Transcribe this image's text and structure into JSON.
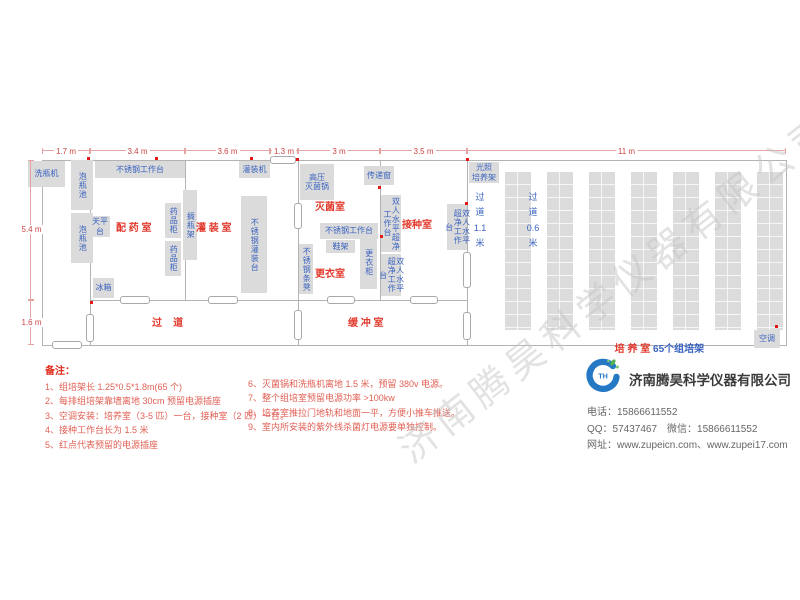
{
  "watermark": "济南腾昊科学仪器有限公司",
  "plan": {
    "dims_top": [
      {
        "label": "1.7 m",
        "x1": 42,
        "x2": 90
      },
      {
        "label": "3.4 m",
        "x1": 90,
        "x2": 185
      },
      {
        "label": "3.6 m",
        "x1": 185,
        "x2": 270
      },
      {
        "label": "1.3 m",
        "x1": 270,
        "x2": 298
      },
      {
        "label": "3 m",
        "x1": 298,
        "x2": 380
      },
      {
        "label": "3.5 m",
        "x1": 380,
        "x2": 467
      },
      {
        "label": "11 m",
        "x1": 467,
        "x2": 786
      }
    ],
    "dims_left": [
      {
        "label": "5.4 m",
        "y1": 160,
        "y2": 300
      },
      {
        "label": "1.6 m",
        "y1": 300,
        "y2": 345
      }
    ],
    "rooms": [
      {
        "name": "room-dispensing",
        "label": "配 药 室",
        "x": 116,
        "y": 219
      },
      {
        "name": "room-filling",
        "label": "灌 装 室",
        "x": 196,
        "y": 219
      },
      {
        "name": "room-sterilizing",
        "label": "灭菌室",
        "x": 315,
        "y": 198
      },
      {
        "name": "room-inoculation",
        "label": "接种室",
        "x": 402,
        "y": 216
      },
      {
        "name": "room-changing",
        "label": "更衣室",
        "x": 315,
        "y": 265
      },
      {
        "name": "corridor",
        "label": "过    道",
        "x": 152,
        "y": 314
      },
      {
        "name": "room-buffer",
        "label": "缓 冲 室",
        "x": 348,
        "y": 314
      }
    ],
    "culture_room_red": "培 养 室 ",
    "culture_room_blue": "65个组培架",
    "corridors": [
      {
        "name": "aisle-1-1m",
        "label": "过\n道\n1.1\n米",
        "x": 472,
        "y": 190
      },
      {
        "name": "aisle-0-6m",
        "label": "过\n道\n0.6\n米",
        "x": 525,
        "y": 190
      }
    ],
    "racks": {
      "count": 7,
      "x": 505,
      "y": 172,
      "w": 26,
      "stride": 42,
      "h": 158
    },
    "equipment": [
      {
        "name": "bottle-washer",
        "label": "洗瓶机",
        "x": 28,
        "y": 161,
        "w": 37,
        "h": 26,
        "v": false
      },
      {
        "name": "soak-pool-1",
        "label": "泡瓶池",
        "x": 71,
        "y": 160,
        "w": 22,
        "h": 50,
        "v": true
      },
      {
        "name": "soak-pool-2",
        "label": "泡瓶池",
        "x": 71,
        "y": 213,
        "w": 22,
        "h": 50,
        "v": true
      },
      {
        "name": "steel-workbench-1",
        "label": "不锈钢工作台",
        "x": 95,
        "y": 161,
        "w": 90,
        "h": 17,
        "v": false
      },
      {
        "name": "filling-machine",
        "label": "灌装机",
        "x": 239,
        "y": 161,
        "w": 31,
        "h": 17,
        "v": false
      },
      {
        "name": "balance-table",
        "label": "天平台",
        "x": 90,
        "y": 216,
        "w": 20,
        "h": 21,
        "v": false
      },
      {
        "name": "medicine-cabinet-1",
        "label": "药品柜",
        "x": 165,
        "y": 203,
        "w": 16,
        "h": 35,
        "v": true
      },
      {
        "name": "medicine-cabinet-2",
        "label": "药品柜",
        "x": 165,
        "y": 241,
        "w": 16,
        "h": 35,
        "v": true
      },
      {
        "name": "bottle-rack",
        "label": "搁瓶架",
        "x": 183,
        "y": 190,
        "w": 14,
        "h": 70,
        "v": true
      },
      {
        "name": "steel-filling-table",
        "label": "不锈钢灌装台",
        "x": 241,
        "y": 196,
        "w": 26,
        "h": 97,
        "v": true
      },
      {
        "name": "fridge",
        "label": "冰箱",
        "x": 93,
        "y": 278,
        "w": 21,
        "h": 20,
        "v": false
      },
      {
        "name": "autoclave",
        "label": "高压\n灭菌锅",
        "x": 300,
        "y": 164,
        "w": 34,
        "h": 36,
        "v": false
      },
      {
        "name": "pass-through-window",
        "label": "传递窗",
        "x": 364,
        "y": 166,
        "w": 30,
        "h": 19,
        "v": false
      },
      {
        "name": "clean-bench-1",
        "label": "双人水平超净工作台",
        "x": 381,
        "y": 195,
        "w": 20,
        "h": 57,
        "v": true
      },
      {
        "name": "steel-workbench-2",
        "label": "不锈钢工作台",
        "x": 320,
        "y": 223,
        "w": 58,
        "h": 16,
        "v": false
      },
      {
        "name": "shoe-rack",
        "label": "鞋架",
        "x": 326,
        "y": 240,
        "w": 29,
        "h": 13,
        "v": false
      },
      {
        "name": "locker",
        "label": "更衣柜",
        "x": 360,
        "y": 236,
        "w": 17,
        "h": 53,
        "v": true
      },
      {
        "name": "steel-bench",
        "label": "不锈钢条凳",
        "x": 299,
        "y": 244,
        "w": 14,
        "h": 50,
        "v": true
      },
      {
        "name": "clean-bench-2",
        "label": "双人水平超净工作台",
        "x": 381,
        "y": 254,
        "w": 20,
        "h": 42,
        "v": true
      },
      {
        "name": "clean-bench-3",
        "label": "双人水平超净工作台",
        "x": 447,
        "y": 204,
        "w": 20,
        "h": 46,
        "v": true
      },
      {
        "name": "light-culture-rack",
        "label": "光照\n培养架",
        "x": 469,
        "y": 162,
        "w": 30,
        "h": 21,
        "v": false
      },
      {
        "name": "air-conditioner",
        "label": "空调",
        "x": 754,
        "y": 330,
        "w": 26,
        "h": 18,
        "v": false
      }
    ],
    "outlets": [
      [
        87,
        157
      ],
      [
        155,
        157
      ],
      [
        250,
        157
      ],
      [
        378,
        186
      ],
      [
        465,
        202
      ],
      [
        775,
        325
      ],
      [
        90,
        301
      ],
      [
        380,
        235
      ],
      [
        296,
        158
      ],
      [
        466,
        158
      ]
    ]
  },
  "notes": {
    "title": "备注：",
    "left": [
      "1、组培架长 1.25*0.5*1.8m(65 个)",
      "2、每排组培架靠墙离地 30cm 预留电源插座",
      "3、空调安装：培养室（3-5 匹）一台，接种室（2 匹）一台。",
      "4、接种工作台长为 1.5 米",
      "5、红点代表预留的电源插座"
    ],
    "right": [
      "6、灭菌锅和洗瓶机离地 1.5 米，预留 380v 电源。",
      "7、整个组培室预留电源功率 >100kw",
      "8、培养室推拉门地轨和地面一平，方便小推车推送。",
      "9、室内所安装的紫外线杀菌灯电源要单独控制。"
    ]
  },
  "company": {
    "name": "济南腾昊科学仪器有限公司",
    "lines": [
      "电话：15866611552",
      "QQ：57437467　微信：15866611552",
      "网址：www.zupeicn.com、www.zupei17.com"
    ]
  }
}
